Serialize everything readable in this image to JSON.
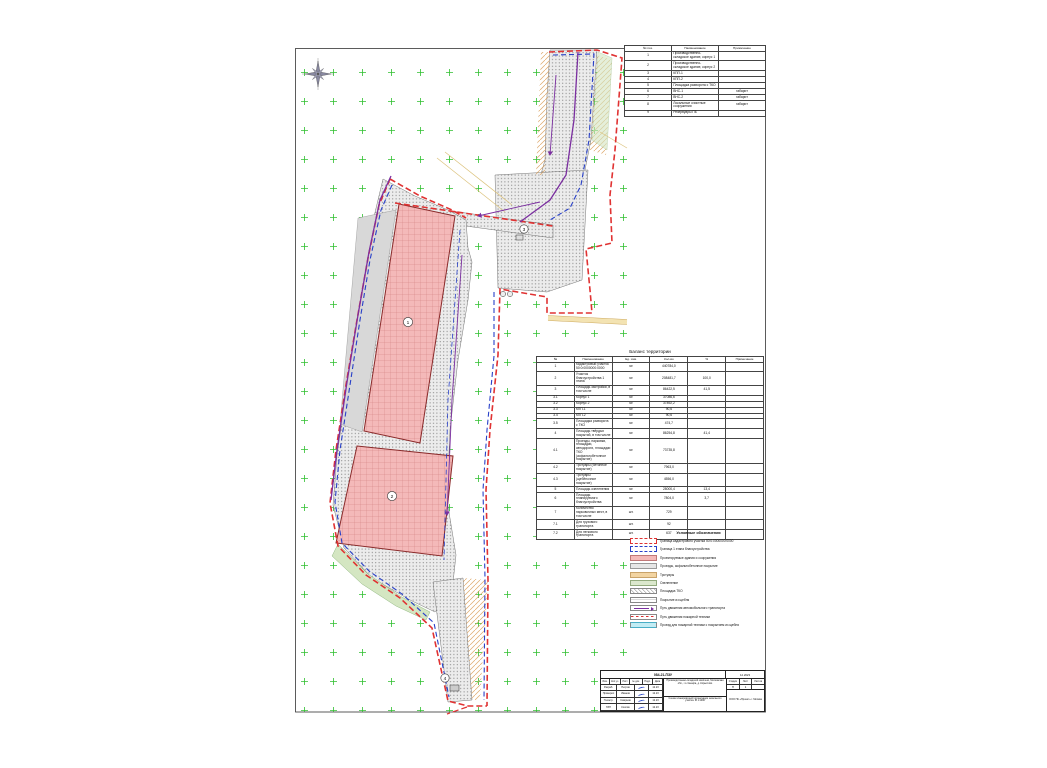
{
  "colors": {
    "c-red": "#e03232",
    "c-blue": "#2840c8",
    "c-purple": "#7b2fa0",
    "c-pink": "#f4b9b9",
    "c-grid-green": "#2fbf2f",
    "c-pavement": "#ececec",
    "c-yellow-road": "#e9c96f"
  },
  "icons": [
    "compass-rose-icon",
    "signature-icon"
  ],
  "explication": {
    "headers": [
      "№ поз.",
      "Наименование",
      "Примечание"
    ],
    "rows": [
      [
        "1",
        "Производственно-складское здание, корпус 1",
        ""
      ],
      [
        "2",
        "Производственно-складское здание, корпус 2",
        ""
      ],
      [
        "3",
        "КПП-1",
        ""
      ],
      [
        "4",
        "КПП-2",
        ""
      ],
      [
        "5",
        "Площадка разворота с ТКО",
        ""
      ],
      [
        "6",
        "ВНС-1",
        "габарит"
      ],
      [
        "7",
        "ВНС-2",
        "габарит"
      ],
      [
        "8",
        "Локальные очистные сооружения",
        "габарит"
      ],
      [
        "9",
        "Резервуары ПБ",
        ""
      ]
    ]
  },
  "balance": {
    "title": "Баланс территории",
    "headers": [
      "№",
      "Наименование",
      "Ед. изм.",
      "Кол-во",
      "%",
      "Примечание"
    ],
    "rows": [
      [
        "1",
        "Кадастровый участок 50:0:0000000:0000",
        "м²",
        "440784,0",
        "",
        ""
      ],
      [
        "2",
        "Участок благоустройства 1 этапа",
        "м²",
        "208481,7",
        "100,0",
        ""
      ],
      [
        "3",
        "Площадь застройки, в том числе",
        "м²",
        "86422,5",
        "41,5",
        ""
      ],
      [
        "3.1",
        "Корпус 1",
        "м²",
        "37086,6",
        "",
        ""
      ],
      [
        "3.2",
        "Корпус 2",
        "м²",
        "37892,2",
        "",
        ""
      ],
      [
        "3.3",
        "КПП-1",
        "м²",
        "90,6",
        "",
        ""
      ],
      [
        "3.4",
        "КПП-2",
        "м²",
        "90,6",
        "",
        ""
      ],
      [
        "3.5",
        "Площадка разворота с ТКО",
        "м²",
        "474,7",
        "",
        ""
      ],
      [
        "4",
        "Площадь твёрдых покрытий, в том числе",
        "м²",
        "86254,8",
        "41,4",
        ""
      ],
      [
        "4.1",
        "Проезды, парковки, площадки, автодороги, площадки ТКО (асфальтобетонное покрытие)",
        "м²",
        "73735,8",
        "",
        ""
      ],
      [
        "4.2",
        "Тротуары (бетонное покрытие)",
        "м²",
        "7963,0",
        "",
        ""
      ],
      [
        "4.3",
        "Тротуары (щебёночное покрытие)",
        "м²",
        "4556,0",
        "",
        ""
      ],
      [
        "5",
        "Площадь озеленения",
        "м²",
        "28000,4",
        "13,4",
        ""
      ],
      [
        "6",
        "Площадь планируемого благоустройства",
        "м²",
        "7804,0",
        "3,7",
        ""
      ],
      [
        "7",
        "Количество парковочных мест, в том числе",
        "шт.",
        "729",
        "",
        ""
      ],
      [
        "7.1",
        "Для грузового транспорта",
        "шт.",
        "92",
        "",
        ""
      ],
      [
        "7.2",
        "Для легкового транспорта",
        "шт.",
        "637",
        "",
        ""
      ]
    ]
  },
  "legend": {
    "title": "Условные обозначения",
    "items": [
      {
        "type": "red-dash",
        "label": "Граница кадастрового участка 50:0:0000000:0000"
      },
      {
        "type": "blue-dash",
        "label": "Граница 1 этапа благоустройства"
      },
      {
        "type": "pink",
        "label": "Проектируемые здания и сооружения"
      },
      {
        "type": "gray",
        "label": "Проезды, асфальтобетонное покрытие"
      },
      {
        "type": "tan",
        "label": "Тротуары"
      },
      {
        "type": "green",
        "label": "Озеленение"
      },
      {
        "type": "hatch",
        "label": "Площадка ТКО"
      },
      {
        "type": "lines",
        "label": "Покрытие из щебня"
      },
      {
        "type": "arrow",
        "label": "Путь движения автомобильного транспорта"
      },
      {
        "type": "red-dots",
        "label": "Путь движения пожарной техники"
      },
      {
        "type": "cyan",
        "label": "Проезд для пожарной техники с покрытием из щебня"
      }
    ]
  },
  "title_block": {
    "top_code": "084-21-ПЗУ",
    "top_right": "12.2023",
    "sign_headers": [
      "Изм.",
      "Кол.уч.",
      "Лист",
      "№ док.",
      "Подп.",
      "Дата"
    ],
    "sign_rows": [
      [
        "Разраб.",
        "Петров",
        "12.23"
      ],
      [
        "Проверил",
        "Иванов",
        "12.23"
      ],
      [
        "Н.контр.",
        "Смирнов",
        "12.23"
      ],
      [
        "ГИП",
        "Козлов",
        "12.23"
      ]
    ],
    "project": "Производственно-складской комплекс, Московская обл., г.о. Кашира, д. Корыстово",
    "sheet_title": "Схема планировочной организации земельного участка. М 1:1000",
    "stage_label": "Стадия",
    "sheet_label": "Лист",
    "sheets_label": "Листов",
    "stage": "П",
    "sheet": "1",
    "sheets": "",
    "org": "ООО ПК «Проект» г. Москва"
  },
  "map": {
    "balloons": [
      "1",
      "2",
      "3",
      "4"
    ]
  }
}
